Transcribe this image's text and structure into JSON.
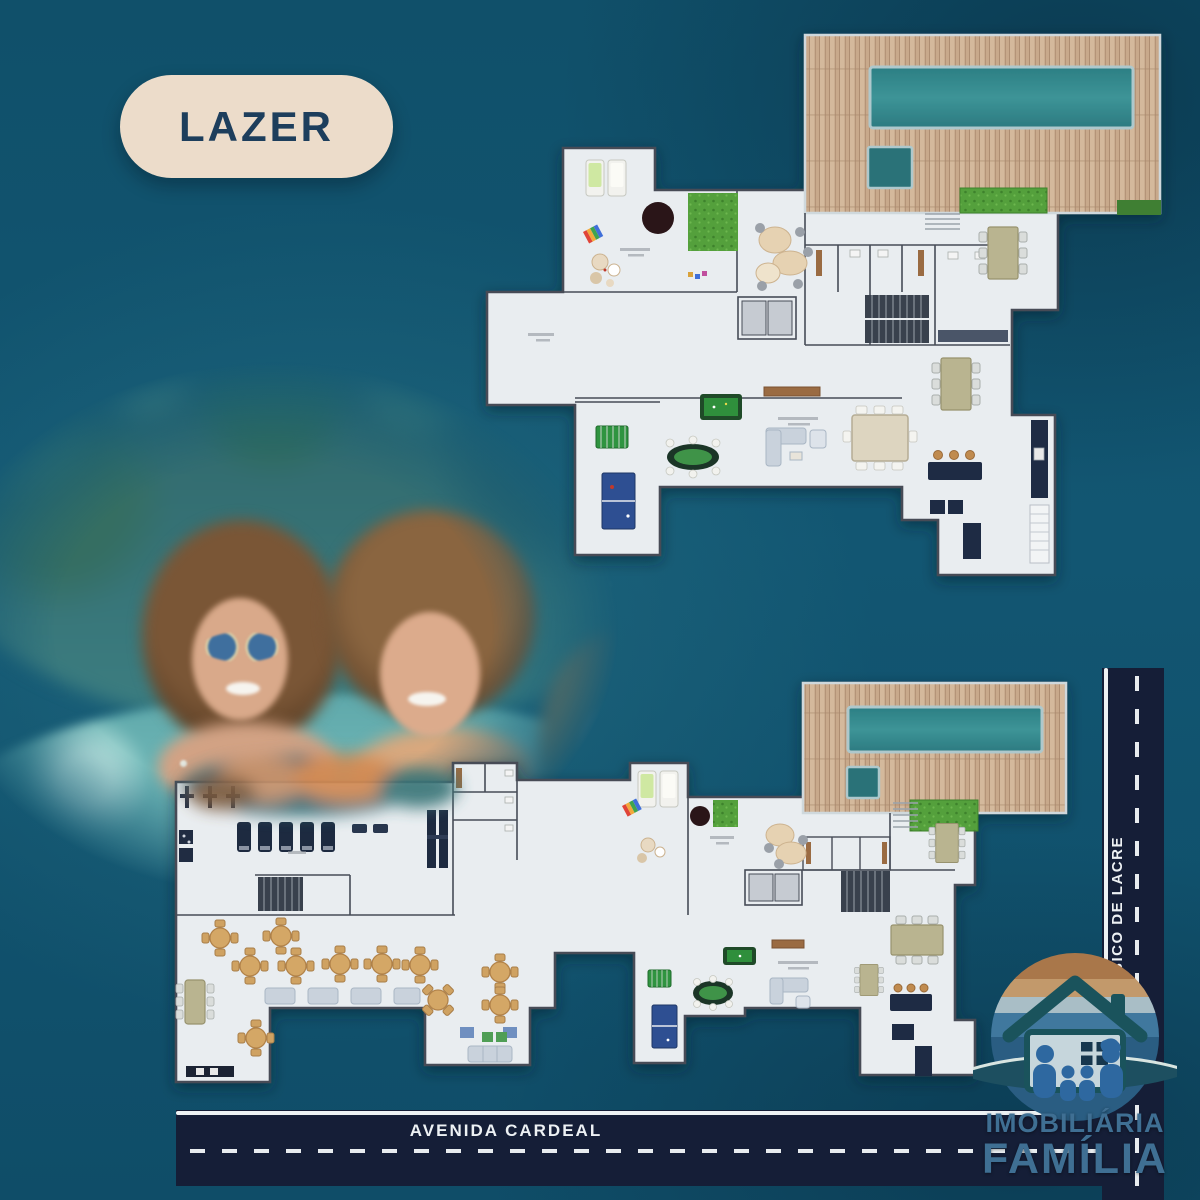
{
  "badge": {
    "label": "LAZER"
  },
  "streets": {
    "horizontal": {
      "label": "AVENIDA CARDEAL"
    },
    "vertical": {
      "label": "RUA BICO DE LACRE"
    }
  },
  "logo": {
    "line1": "IMOBILIÁRIA",
    "line2": "FAMÍLIA",
    "emblem": "house-family-sunset-wave-icon"
  },
  "scene": {
    "type": "real-estate leisure area poster with two floor plans",
    "photo": "three-friends-smiling-in-pool-photo"
  },
  "plans": {
    "top": {
      "features": [
        "wood-deck",
        "swimming-pool",
        "kids-pool",
        "grass-patch",
        "playground",
        "loungers",
        "lounge-seating",
        "restrooms",
        "elevators",
        "stairs",
        "dining-tables",
        "sofa-lounge",
        "sideboard",
        "pool-table",
        "foosball-table",
        "poker-table",
        "ping-pong-table",
        "bar-counter",
        "kitchen-counter",
        "shelving"
      ]
    },
    "bottom": {
      "features": [
        "wood-deck",
        "swimming-pool",
        "kids-pool",
        "grass-patch",
        "gym",
        "treadmills",
        "weight-stations",
        "cable-machines",
        "changing-rooms",
        "party-hall",
        "round-tables",
        "sofa-row",
        "long-table",
        "kitchen-counter",
        "playground",
        "loungers",
        "lounge-seating",
        "elevators",
        "stairs",
        "pool-table",
        "foosball-table",
        "poker-table",
        "ping-pong-table",
        "bar-counter",
        "dining-tables"
      ]
    }
  },
  "colors": {
    "background": "#11506a",
    "road": "#151e37",
    "road_line": "#eef2f4",
    "badge_bg": "#ecdcca",
    "badge_text": "#1d3e5c",
    "plan_floor": "#e9edf0",
    "plan_wall": "#474c57",
    "deck_wood": "#c8a98b",
    "pool_water": "#2f8a8c",
    "grass": "#55a23e",
    "logo_text": "#3f6f93"
  }
}
